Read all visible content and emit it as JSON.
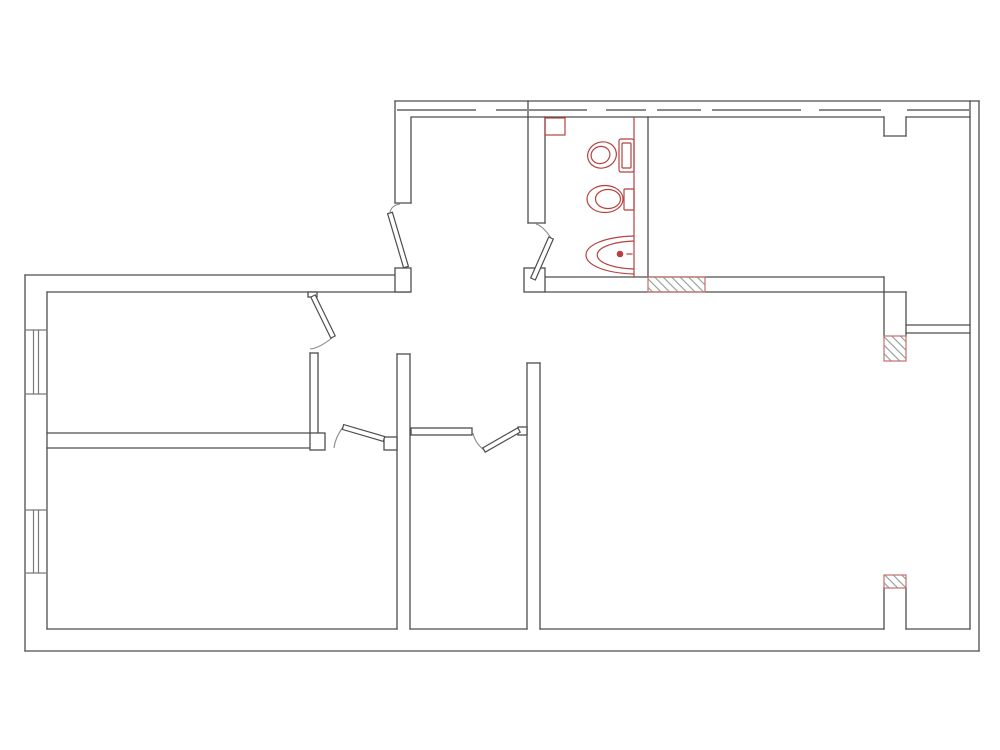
{
  "drawing": {
    "type": "architectural-floor-plan",
    "canvas": {
      "width": 1000,
      "height": 750,
      "background": "#ffffff"
    },
    "colors": {
      "wall": "#4d4d4d",
      "gray": "#8a8a8a",
      "window": "#7a7a7a",
      "fixture_red": "#b5423f",
      "hatch_border": "#c4706c",
      "hatch_line": "#8f9b99",
      "fill_white": "#ffffff"
    },
    "walls": [
      [
        25,
        275,
        397,
        275
      ],
      [
        25,
        275,
        25,
        651
      ],
      [
        25,
        651,
        979,
        651
      ],
      [
        979,
        101,
        979,
        651
      ],
      [
        395,
        101,
        979,
        101
      ],
      [
        970,
        101,
        970,
        629
      ],
      [
        47,
        292,
        47,
        629
      ],
      [
        47,
        292,
        410,
        292
      ],
      [
        47,
        629,
        397,
        629
      ],
      [
        410,
        629,
        527,
        629
      ],
      [
        540,
        629,
        884,
        629
      ],
      [
        906,
        629,
        970,
        629
      ],
      [
        395,
        101,
        395,
        203
      ],
      [
        411,
        118,
        411,
        203
      ],
      [
        395,
        203,
        411,
        203
      ],
      [
        411,
        117,
        884,
        117
      ],
      [
        906,
        117,
        970,
        117
      ],
      [
        884,
        117,
        884,
        136
      ],
      [
        884,
        136,
        906,
        136
      ],
      [
        906,
        136,
        906,
        117
      ],
      [
        528,
        101,
        528,
        223
      ],
      [
        545,
        117,
        545,
        223
      ],
      [
        528,
        223,
        545,
        223
      ],
      [
        545,
        277,
        884,
        277
      ],
      [
        545,
        292,
        906,
        292
      ],
      [
        648,
        117,
        648,
        277
      ],
      [
        884,
        277,
        884,
        336
      ],
      [
        906,
        292,
        906,
        336
      ],
      [
        906,
        325,
        970,
        325
      ],
      [
        906,
        333,
        970,
        333
      ],
      [
        527,
        363,
        527,
        629
      ],
      [
        540,
        363,
        540,
        629
      ],
      [
        527,
        363,
        540,
        363
      ],
      [
        397,
        354,
        397,
        629
      ],
      [
        410,
        354,
        410,
        629
      ],
      [
        397,
        354,
        410,
        354
      ],
      [
        310,
        353,
        310,
        433
      ],
      [
        318,
        353,
        318,
        433
      ],
      [
        310,
        353,
        318,
        353
      ],
      [
        47,
        433,
        310,
        433
      ],
      [
        47,
        448,
        310,
        448
      ],
      [
        884,
        588,
        884,
        629
      ],
      [
        906,
        588,
        906,
        629
      ]
    ],
    "window_lines": [
      [
        25,
        330,
        47,
        330
      ],
      [
        25,
        394,
        47,
        394
      ],
      [
        33.5,
        330,
        33.5,
        394
      ],
      [
        38.5,
        330,
        38.5,
        394
      ],
      [
        25,
        510,
        47,
        510
      ],
      [
        25,
        573,
        47,
        573
      ],
      [
        33.5,
        510,
        33.5,
        573
      ],
      [
        38.5,
        510,
        38.5,
        573
      ]
    ],
    "dash_lines": [
      [
        398,
        110,
        475,
        110
      ],
      [
        497,
        110,
        586,
        110
      ],
      [
        607,
        110,
        645,
        110
      ],
      [
        658,
        110,
        700,
        110
      ],
      [
        713,
        110,
        800,
        110
      ],
      [
        820,
        110,
        880,
        110
      ],
      [
        908,
        110,
        968,
        110
      ]
    ],
    "red_lines": [
      [
        634,
        117,
        634,
        277
      ],
      [
        627,
        254,
        632,
        254
      ]
    ],
    "posts": [
      {
        "x": 395,
        "y": 268,
        "w": 16,
        "h": 24,
        "name": "door-post-entry"
      },
      {
        "x": 524,
        "y": 268,
        "w": 21,
        "h": 24,
        "name": "door-post-bathroom"
      },
      {
        "x": 310,
        "y": 433,
        "w": 15,
        "h": 17,
        "name": "wall-post-divider"
      },
      {
        "x": 384,
        "y": 437,
        "w": 13,
        "h": 13,
        "name": "door-jamb-tab-left-room"
      },
      {
        "x": 518,
        "y": 427,
        "w": 9,
        "h": 8,
        "name": "door-jamb-tab-closet"
      },
      {
        "x": 308,
        "y": 292,
        "w": 9,
        "h": 5,
        "name": "door-hinge-tab-top-room"
      },
      {
        "x": 411,
        "y": 428,
        "w": 61,
        "h": 7,
        "name": "closet-partition-wall"
      }
    ],
    "hatched_areas": [
      {
        "x": 648,
        "y": 277,
        "w": 57,
        "h": 15,
        "name": "hatched-wall-section-1"
      },
      {
        "x": 884,
        "y": 336,
        "w": 22,
        "h": 25,
        "name": "hatched-wall-section-2"
      },
      {
        "x": 884,
        "y": 575,
        "w": 22,
        "h": 13,
        "name": "hatched-wall-section-3"
      }
    ],
    "red_boxes": [
      {
        "x": 545,
        "y": 118,
        "w": 20,
        "h": 17,
        "name": "bathroom-duct-box"
      }
    ],
    "doors": [
      {
        "name": "door-entry-hall",
        "leaf": "408.4,266.3 392.4,212.3 387.6,213.7 403.6,267.7",
        "arc": "M390,212 Q392,205 400,204"
      },
      {
        "name": "door-bathroom",
        "leaf": "535.3,280.0 553.3,239.0 548.7,237.0 530.7,278.0",
        "arc": "M551,238 Q543,226 536,224"
      },
      {
        "name": "door-top-left-room",
        "leaf": "310.8,297.1 330.8,338.1 335.2,335.9 315.2,294.9",
        "arc": "M333,337 Q320,348 310,349"
      },
      {
        "name": "door-lower-left-room",
        "leaf": "384.7,436.6 343.7,424.6 342.3,429.4 383.3,441.4",
        "arc": "M343,427 Q335,438 334,448"
      },
      {
        "name": "door-closet",
        "leaf": "517.8,427.8 482.8,447.8 485.2,452.2 520.2,432.2",
        "arc": "M484,450 Q475,443 473,433"
      }
    ],
    "fixtures": [
      {
        "name": "toilet-with-tank-icon",
        "shapes": [
          {
            "t": "rect",
            "x": 619,
            "y": 139,
            "w": 15,
            "h": 33,
            "rx": 2
          },
          {
            "t": "rect",
            "x": 622,
            "y": 143,
            "w": 9,
            "h": 25,
            "rx": 1
          },
          {
            "t": "ellipse",
            "cx": 602,
            "cy": 155,
            "rx": 14.5,
            "ry": 13,
            "rot": -18
          },
          {
            "t": "ellipse",
            "cx": 600.5,
            "cy": 155,
            "rx": 9.5,
            "ry": 8.5,
            "rot": -18
          }
        ]
      },
      {
        "name": "wall-hung-toilet-icon",
        "shapes": [
          {
            "t": "rect",
            "x": 624,
            "y": 189,
            "w": 10,
            "h": 21,
            "rx": 1
          },
          {
            "t": "ellipse",
            "cx": 605,
            "cy": 199,
            "rx": 18,
            "ry": 13.5,
            "rot": 0
          },
          {
            "t": "ellipse",
            "cx": 608,
            "cy": 199,
            "rx": 12.5,
            "ry": 9.5,
            "rot": 0
          }
        ]
      },
      {
        "name": "washbasin-icon",
        "shapes": [
          {
            "t": "path",
            "d": "M634,236 C570,238 570,272 634,274"
          },
          {
            "t": "path",
            "d": "M634,241 C585,243 585,267 634,269"
          },
          {
            "t": "circle",
            "cx": 620,
            "cy": 254,
            "r": 2.8,
            "fill": 1
          }
        ]
      }
    ]
  }
}
